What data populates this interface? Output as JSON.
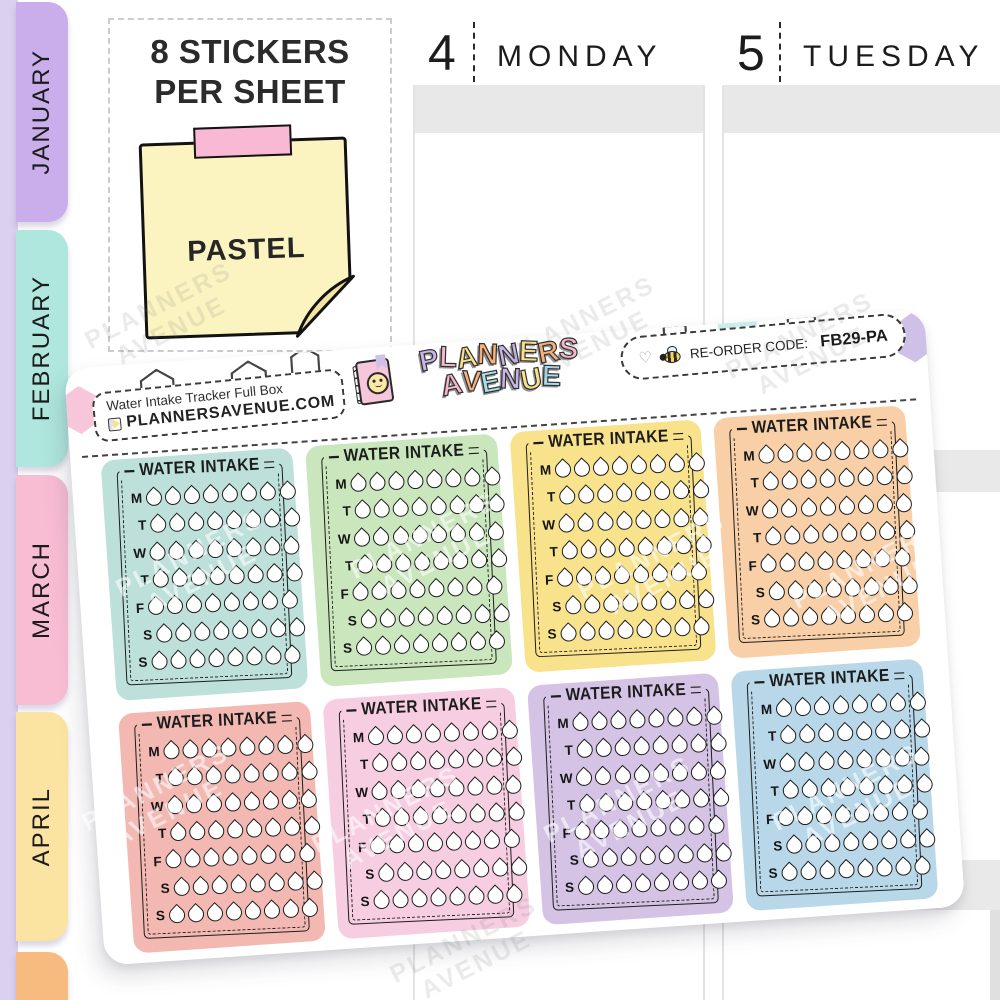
{
  "sidebar": {
    "strip_color": "#dbd0f0",
    "months": [
      {
        "label": "JANUARY",
        "color": "#c9aeeb"
      },
      {
        "label": "FEBRUARY",
        "color": "#afe7de"
      },
      {
        "label": "MARCH",
        "color": "#f9bdd3"
      },
      {
        "label": "APRIL",
        "color": "#fbe3a1"
      },
      {
        "label": "",
        "color": "#f7ba7f"
      }
    ]
  },
  "planner": {
    "bar_color": "#e8e8e8",
    "days": [
      {
        "number": "4",
        "name": "MONDAY"
      },
      {
        "number": "5",
        "name": "TUESDAY"
      }
    ]
  },
  "info": {
    "heading_line1": "8 STICKERS",
    "heading_line2": "PER SHEET",
    "note_text": "PASTEL",
    "note_color": "#fbf4c1",
    "note_fold_color": "#f1e5a3",
    "tape_color": "#f9b9d5"
  },
  "sheet": {
    "product_title": "Water Intake Tracker Full Box",
    "website": "PLANNERSAVENUE.COM",
    "brand": {
      "line1": "PLANNERS",
      "line2": "AVENUE",
      "line1_colors": [
        "#cbb3e8",
        "#f8b7ce",
        "#fbe08a",
        "#f8b07a",
        "#cbb3e8",
        "#fbe08a",
        "#f8b07a",
        "#f8b7ce"
      ],
      "line2_colors": [
        "#f8b7ce",
        "#f8b07a",
        "#aadcec",
        "#cbb3e8",
        "#fbe08a",
        "#aadcec"
      ]
    },
    "reorder_label": "RE-ORDER CODE:",
    "reorder_code": "FB29-PA",
    "watermark": {
      "line1": "PLANNERS",
      "line2": "AVENUE"
    },
    "hex_colors": {
      "pink": "#f7c6da",
      "yellow": "#fbe7a8",
      "cyan": "#c9ecec",
      "lavender": "#cfc0e8"
    },
    "sticker": {
      "title": "WATER INTAKE",
      "day_letters": [
        "M",
        "T",
        "W",
        "T",
        "F",
        "S",
        "S"
      ],
      "drops_per_row": 8,
      "colors": [
        "#bde0da",
        "#c9e6bd",
        "#f8e28b",
        "#f8cfa6",
        "#f3b8b2",
        "#f7cde2",
        "#d5c3e6",
        "#b8d8e9"
      ]
    }
  }
}
